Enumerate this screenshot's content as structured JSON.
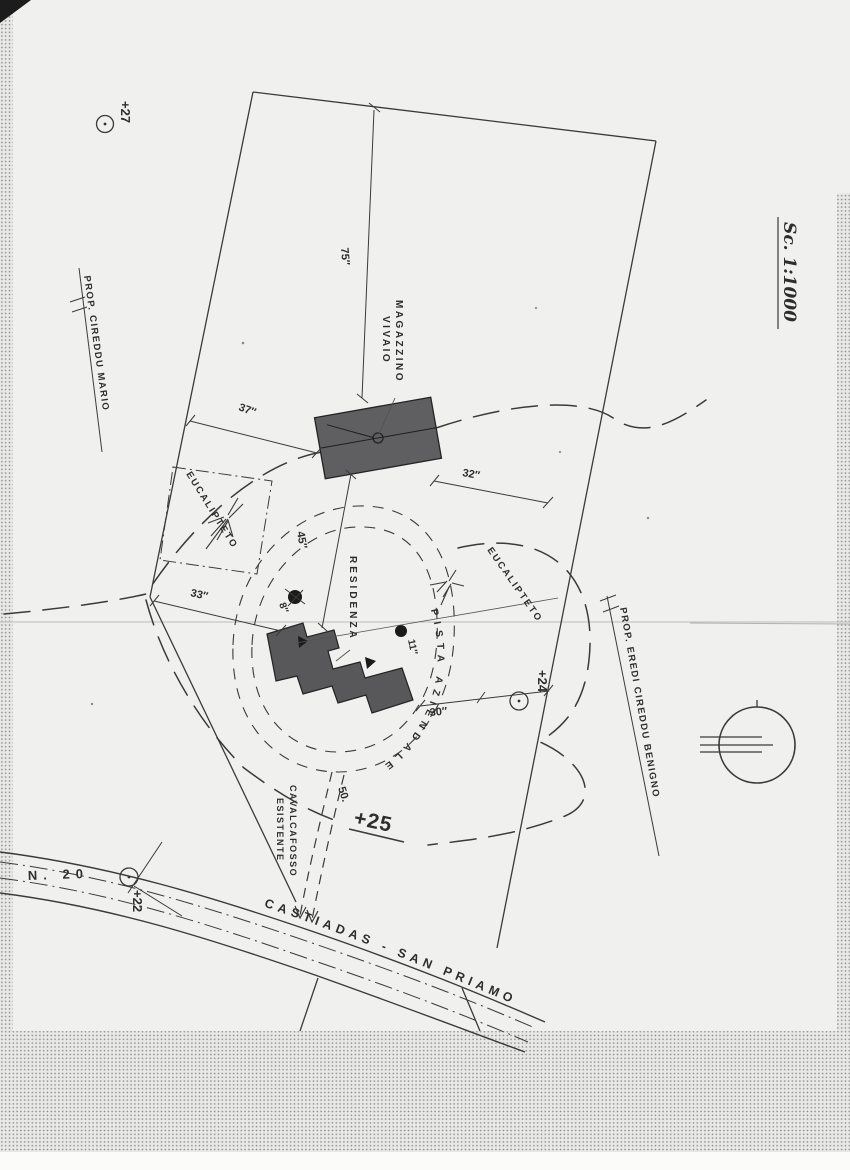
{
  "page": {
    "scale_label": "Sc. 1:1000",
    "property_labels": {
      "left": "PROP. CIREDDU MARIO",
      "right": "PROP. EREDI CIREDDU BENIGNO"
    },
    "buildings": {
      "magazzino_line1": "MAGAZZINO",
      "magazzino_line2": "VIVAIO",
      "residenza": "RESIDENZA"
    },
    "vegetation": {
      "eucalipteto_left": "EUCALIPTETO",
      "eucalipteto_right": "EUCALIPTETO"
    },
    "paths": {
      "pista_aziendale": "PISTA AZIENDALE",
      "cavalcafosso_line1": "CAVALCAFOSSO",
      "cavalcafosso_line2": "ESISTENTE"
    },
    "road": {
      "number": "N. 20",
      "name": "CASTIADAS - SAN PRIAMO"
    },
    "elevations": {
      "e27": "+27",
      "e24": "+24",
      "e25": "+25",
      "e22": "+22"
    },
    "dimensions": {
      "d75": "75″",
      "d37": "37″",
      "d32": "32″",
      "d45": "45″",
      "d33": "33″",
      "d30": "30″",
      "d50": "50.",
      "d8": "8″",
      "d11": "11″"
    }
  }
}
